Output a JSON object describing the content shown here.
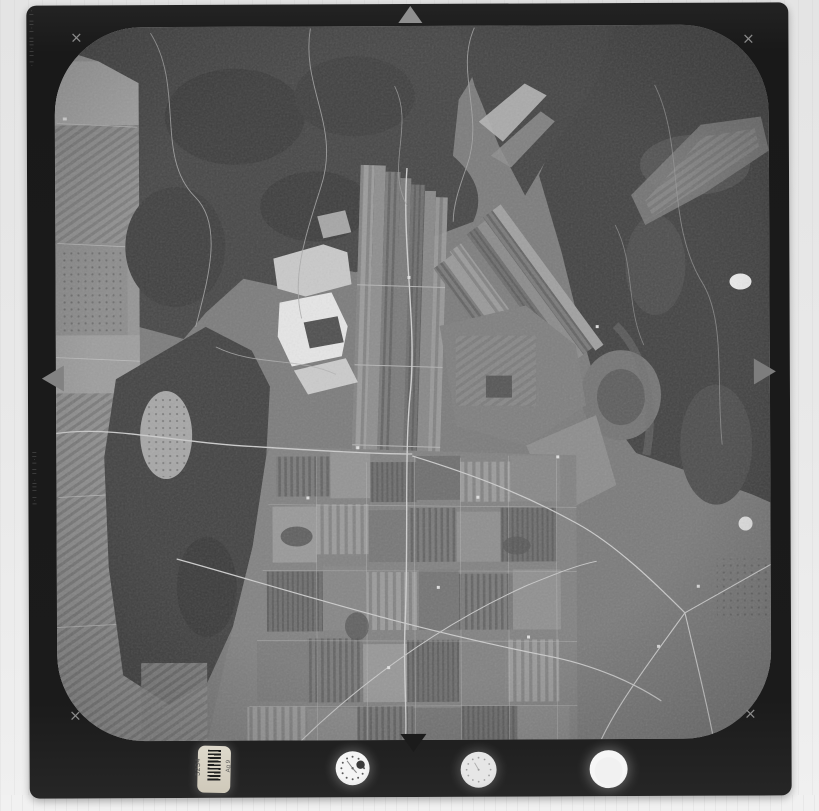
{
  "scan": {
    "corner_marks": {
      "top_left": "×",
      "top_right": "×",
      "bottom_left": "×",
      "bottom_right": "×"
    },
    "edge_markings": {
      "top": "·| ||·| |||·|| |·",
      "middle": "||·| || ·||| |·|"
    },
    "label": {
      "number": "5234",
      "code": "Ag 9"
    }
  }
}
